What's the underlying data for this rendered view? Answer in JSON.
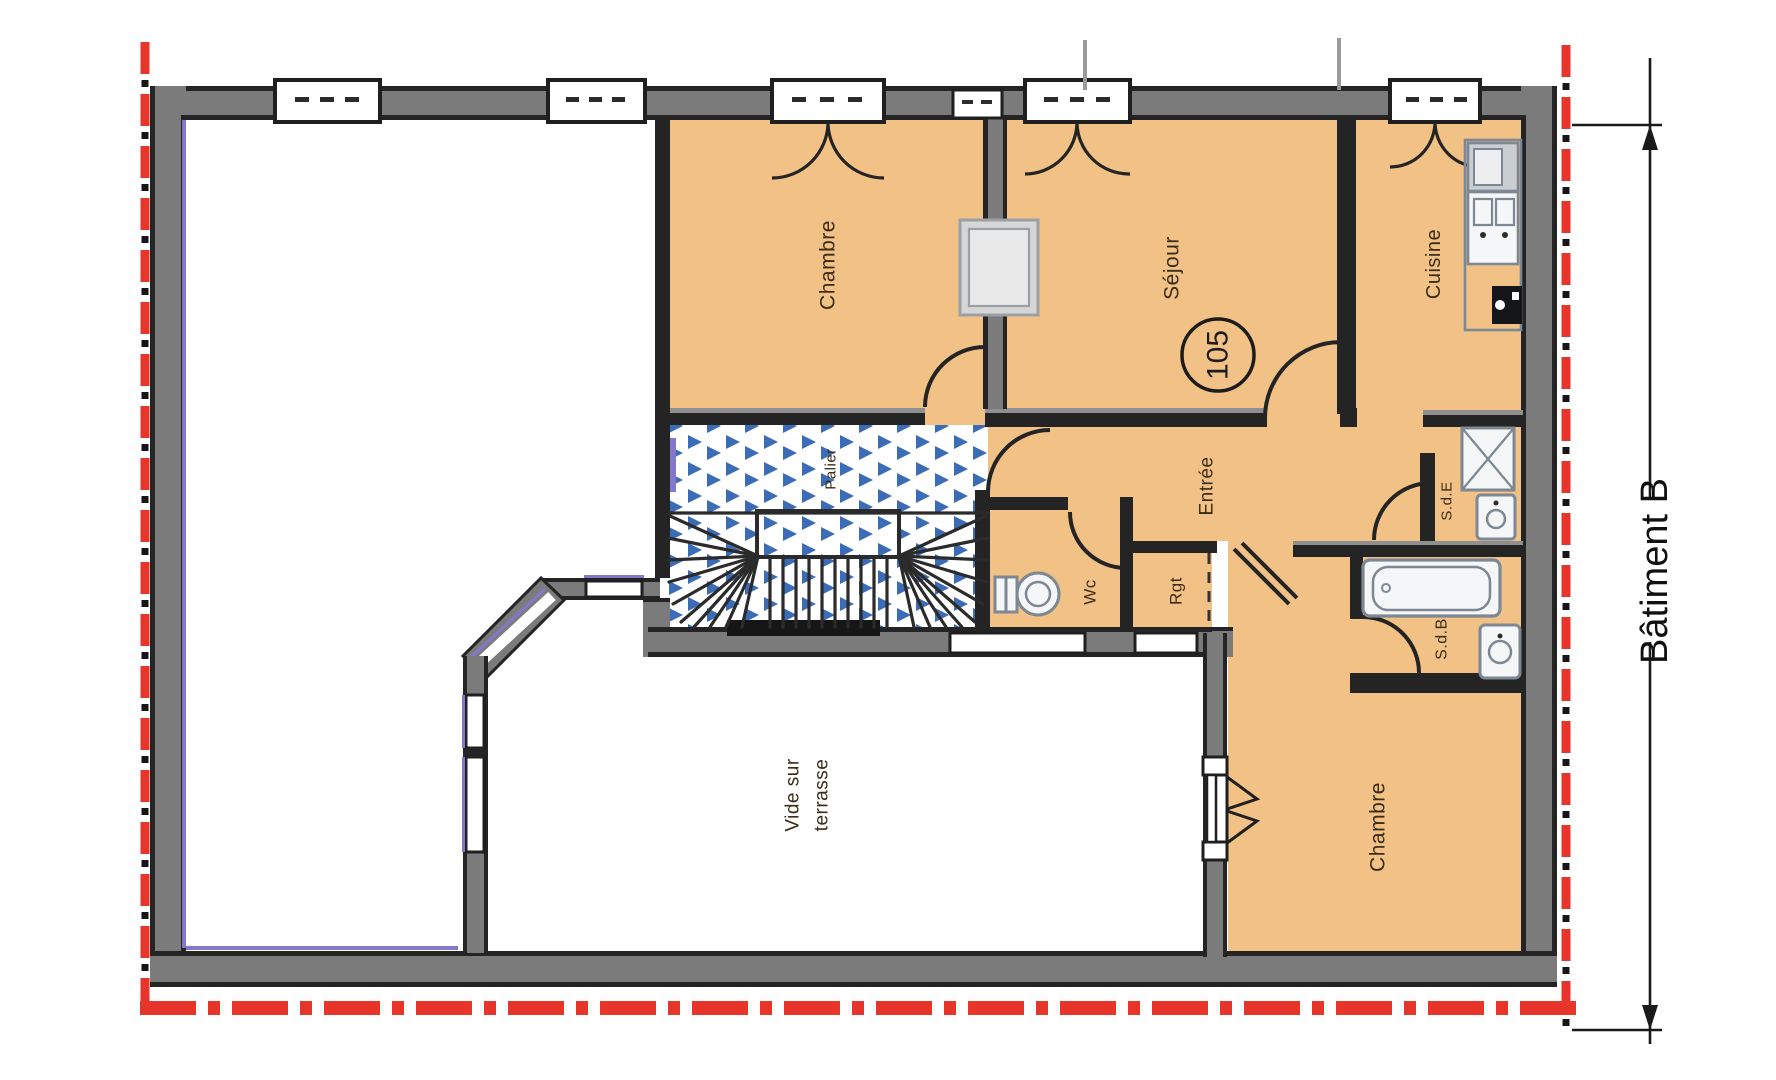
{
  "plan": {
    "building_label": "Bâtiment B",
    "unit_number": "105",
    "rooms": {
      "chambre_nw": "Chambre",
      "sejour": "Séjour",
      "cuisine": "Cuisine",
      "entree": "Entrée",
      "wc": "Wc",
      "rgt": "Rgt",
      "sde": "S.d.E",
      "sdb": "S.d.B",
      "chambre_se": "Chambre",
      "palier": "Palier",
      "vide_line1": "Vide sur",
      "vide_line2": "terrasse"
    },
    "fixtures": [
      "toilet",
      "bathtub",
      "shower",
      "washbasin",
      "washbasin",
      "kitchen-sink",
      "duct-flue"
    ],
    "colors": {
      "room_fill": "#f2c185",
      "wall_gray": "#7b7b7b",
      "wall_dark": "#242424",
      "boundary_red": "#e8352b",
      "stair_blue": "#3b6cb5",
      "glazing_purple": "#8478cc",
      "fixture_gray": "#7d8894",
      "label_brown": "#3a2c16"
    }
  }
}
